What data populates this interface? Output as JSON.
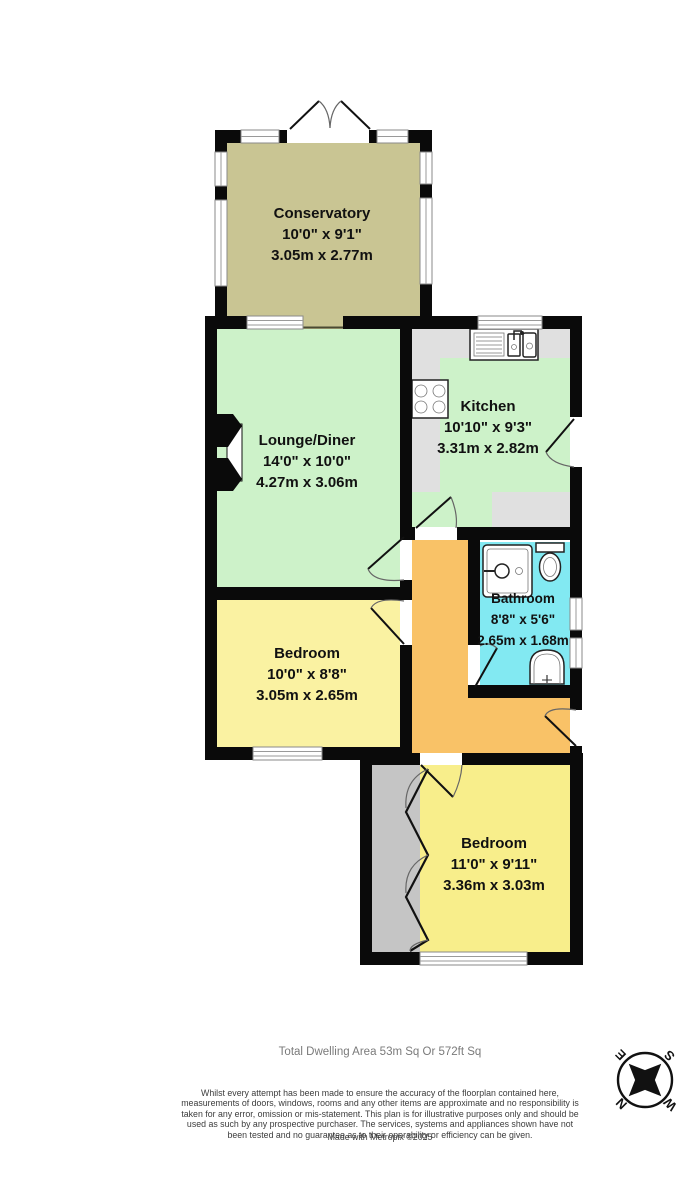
{
  "plan": {
    "rooms": {
      "conservatory": {
        "name": "Conservatory",
        "imperial": "10'0\"  x 9'1\"",
        "metric": "3.05m  x 2.77m"
      },
      "lounge": {
        "name": "Lounge/Diner",
        "imperial": "14'0\"  x 10'0\"",
        "metric": "4.27m  x 3.06m"
      },
      "kitchen": {
        "name": "Kitchen",
        "imperial": "10'10\"  x 9'3\"",
        "metric": "3.31m  x 2.82m"
      },
      "bathroom": {
        "name": "Bathroom",
        "imperial": "8'8\"  x 5'6\"",
        "metric": "2.65m  x 1.68m"
      },
      "bedroom1": {
        "name": "Bedroom",
        "imperial": "10'0\"  x 8'8\"",
        "metric": "3.05m  x 2.65m"
      },
      "bedroom2": {
        "name": "Bedroom",
        "imperial": "11'0\"  x 9'11\"",
        "metric": "3.36m  x 3.03m"
      }
    },
    "compass": {
      "n": "N",
      "e": "E",
      "s": "S",
      "w": "W"
    }
  },
  "colors": {
    "conservatory": "#c9c593",
    "room_green": "#cdf2c9",
    "kitchen_counter": "#e0e0e0",
    "bathroom_cyan": "#82e9f2",
    "bedroom_yellow": "#faf2a2",
    "bedroom2_yellow": "#f8ee8b",
    "hallway_orange": "#f9c267",
    "wardrobe_gray": "#c5c5c5"
  },
  "footer": {
    "total_area": "Total Dwelling Area 53m Sq Or 572ft Sq",
    "disclaimer": "Whilst every attempt has been made to ensure the accuracy of the floorplan contained here, measurements of doors, windows, rooms and any other items are approximate and no responsibility is taken for any error, omission or mis-statement. This plan is for illustrative purposes only and should be used as such by any prospective purchaser. The services, systems and appliances shown have not been tested and no guarantee as to their operability or efficiency can be given.",
    "credit": "Made with Metropix ©2025"
  }
}
